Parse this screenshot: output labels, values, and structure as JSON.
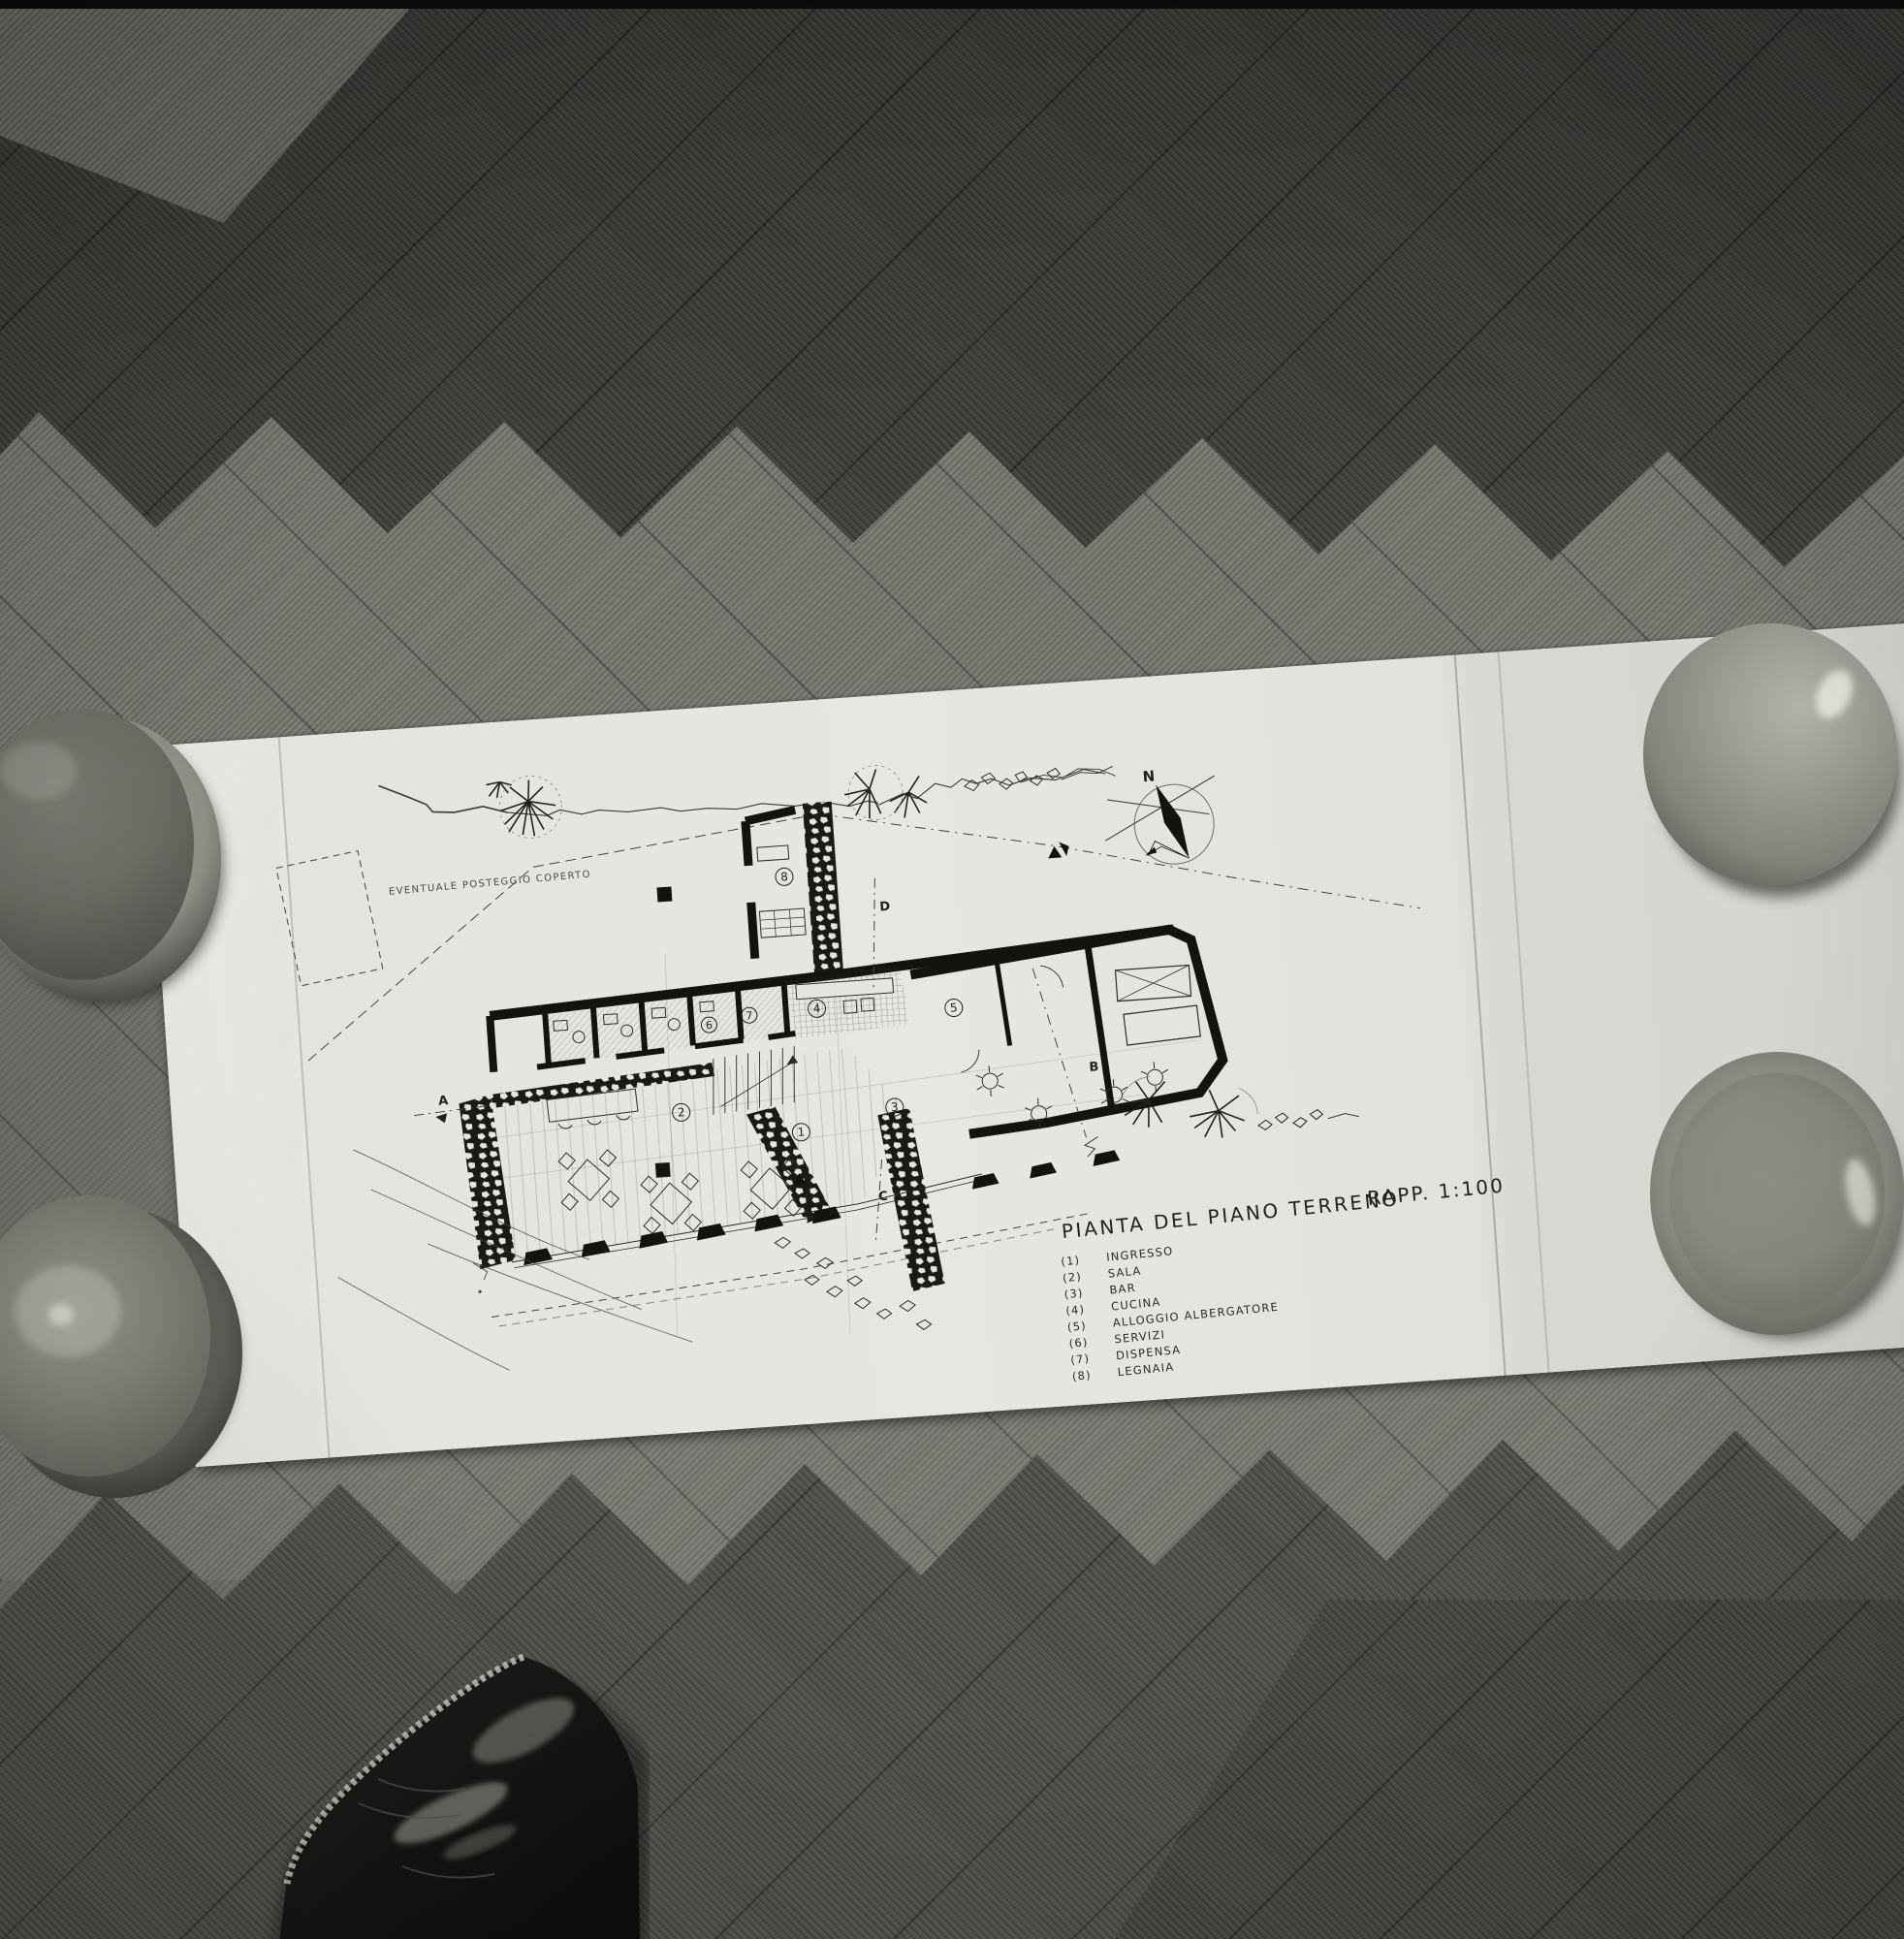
{
  "drawing": {
    "title": "PIANTA DEL PIANO TERRENO",
    "scale_label": "RAPP. 1:100",
    "site_note": "EVENTUALE POSTEGGIO COPERTO",
    "compass": {
      "north_label": "N"
    },
    "legend": {
      "items": [
        {
          "number": "(1)",
          "label": "INGRESSO"
        },
        {
          "number": "(2)",
          "label": "SALA"
        },
        {
          "number": "(3)",
          "label": "BAR"
        },
        {
          "number": "(4)",
          "label": "CUCINA"
        },
        {
          "number": "(5)",
          "label": "ALLOGGIO ALBERGATORE"
        },
        {
          "number": "(6)",
          "label": "SERVIZI"
        },
        {
          "number": "(7)",
          "label": "DISPENSA"
        },
        {
          "number": "(8)",
          "label": "LEGNAIA"
        }
      ]
    },
    "room_numbers": [
      "1",
      "2",
      "3",
      "4",
      "5",
      "6",
      "7",
      "8"
    ],
    "section_markers": [
      "A",
      "B",
      "C",
      "D"
    ]
  },
  "colors": {
    "paper": "#e6e5e0",
    "ink": "#23211e",
    "floor_dark": "#3f3e3a",
    "floor_light": "#7a7972",
    "bowl_gray": "#8e8d87",
    "shoe_black": "#161513"
  }
}
